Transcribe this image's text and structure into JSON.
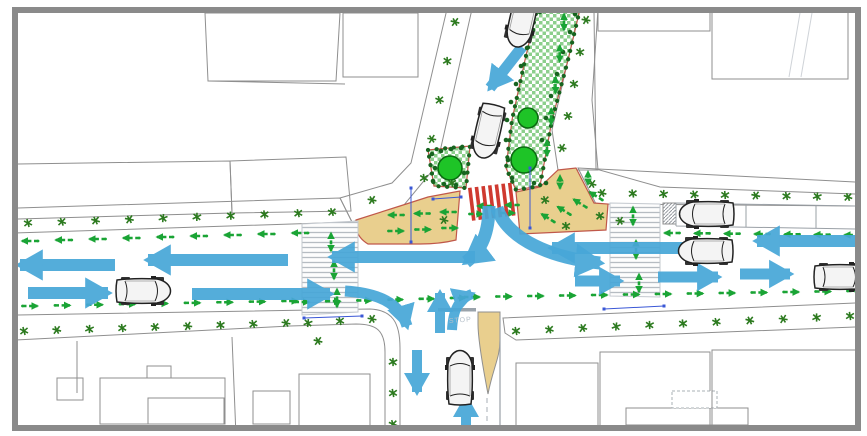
{
  "labels": {
    "stop_marking": "STOP"
  },
  "palette": {
    "frame": "#8a8a8a",
    "hatchline": "#ccd1d8",
    "outline": "#8f8f8f",
    "sidewalk": "#f5e7bd",
    "bulbout": "#e9cf8e",
    "road": "#ffffff",
    "checker": "#8ccf8c",
    "shrub": "#17641f",
    "tree": "#1ec427",
    "treestroke": "#0c6b12",
    "ped": "#1aa435",
    "plant": "#2c7a1f",
    "blue": "#48a7d8",
    "red": "#cf3a30",
    "red2": "#c0584a",
    "dim": "#3a57d6",
    "cwline": "#b6bcc2",
    "stop": "#b6c0ca",
    "curb": "#9aa3ab"
  },
  "map": {
    "plant_rows": [
      [
        28,
        223,
        332,
        212,
        10
      ],
      [
        455,
        22,
        424,
        178,
        5
      ],
      [
        602,
        193,
        848,
        197,
        9
      ],
      [
        24,
        331,
        286,
        323,
        9
      ],
      [
        308,
        323,
        372,
        319,
        3
      ],
      [
        393,
        362,
        393,
        424,
        3
      ],
      [
        516,
        331,
        850,
        316,
        11
      ],
      [
        586,
        20,
        562,
        148,
        5
      ]
    ],
    "plant_scatter": [
      [
        372,
        200
      ],
      [
        452,
        183
      ],
      [
        444,
        220
      ],
      [
        545,
        200
      ],
      [
        592,
        184
      ],
      [
        600,
        216
      ],
      [
        566,
        226
      ],
      [
        620,
        221
      ],
      [
        318,
        341
      ]
    ],
    "shrub_dots": [
      [
        540,
        12
      ],
      [
        533,
        30
      ],
      [
        527,
        48
      ],
      [
        521,
        66
      ],
      [
        516,
        84
      ],
      [
        511,
        102
      ],
      [
        507,
        120
      ],
      [
        506,
        140
      ],
      [
        508,
        160
      ],
      [
        512,
        178
      ],
      [
        534,
        183
      ],
      [
        546,
        183
      ],
      [
        575,
        14
      ],
      [
        570,
        32
      ],
      [
        563,
        52
      ],
      [
        557,
        74
      ],
      [
        551,
        96
      ],
      [
        546,
        118
      ],
      [
        542,
        140
      ],
      [
        432,
        154
      ],
      [
        441,
        151
      ],
      [
        451,
        149
      ],
      [
        461,
        148
      ],
      [
        435,
        168
      ],
      [
        433,
        181
      ],
      [
        444,
        184
      ],
      [
        456,
        185
      ],
      [
        464,
        173
      ]
    ],
    "trees": [
      [
        450,
        168,
        12
      ],
      [
        524,
        160,
        13
      ],
      [
        528,
        118,
        10
      ]
    ],
    "ped_rows": [
      [
        30,
        241,
        300,
        233,
        9,
        180,
        16,
        false
      ],
      [
        672,
        233,
        852,
        235,
        7,
        180,
        15,
        false
      ],
      [
        30,
        306,
        290,
        301,
        9,
        0,
        15,
        false
      ],
      [
        302,
        302,
        458,
        298,
        6,
        0,
        14,
        false
      ],
      [
        472,
        297,
        855,
        291,
        13,
        0,
        15,
        false
      ],
      [
        564,
        22,
        547,
        148,
        5,
        90,
        16,
        true
      ],
      [
        331,
        242,
        337,
        298,
        3,
        270,
        18,
        true
      ],
      [
        633,
        216,
        639,
        283,
        3,
        270,
        18,
        true
      ],
      [
        484,
        206,
        512,
        205,
        2,
        180,
        13,
        false
      ],
      [
        476,
        214,
        508,
        213,
        2,
        0,
        13,
        false
      ],
      [
        396,
        215,
        448,
        212,
        3,
        180,
        15,
        false
      ],
      [
        396,
        231,
        450,
        228,
        3,
        0,
        15,
        false
      ],
      [
        596,
        196,
        548,
        218,
        4,
        212,
        15,
        false
      ],
      [
        560,
        182,
        588,
        178,
        2,
        270,
        13,
        true
      ]
    ],
    "vehicle_arrows": [
      [
        20,
        265,
        180,
        95,
        12
      ],
      [
        148,
        260,
        180,
        140,
        12
      ],
      [
        332,
        257,
        180,
        143,
        12
      ],
      [
        552,
        248,
        180,
        138,
        12
      ],
      [
        757,
        241,
        180,
        100,
        12
      ],
      [
        108,
        293,
        0,
        80,
        12
      ],
      [
        330,
        294,
        0,
        138,
        12
      ],
      [
        620,
        281,
        0,
        45,
        11
      ],
      [
        718,
        277,
        0,
        60,
        11
      ],
      [
        790,
        274,
        0,
        50,
        11
      ],
      [
        417,
        392,
        90,
        42,
        10
      ],
      [
        440,
        293,
        270,
        40,
        10
      ],
      [
        466,
        398,
        270,
        38,
        10
      ],
      [
        490,
        88,
        128,
        52,
        11
      ]
    ],
    "vehicle_turns": [
      [
        "M345,291 C378,293 400,303 407,326",
        11
      ],
      [
        "M489,206 C489,232 482,250 466,262",
        13
      ],
      [
        "M497,208 C508,240 552,258 600,263",
        13
      ],
      [
        "M452,330 C453,311 458,299 472,294",
        10
      ]
    ],
    "cars": [
      [
        522,
        20,
        103
      ],
      [
        488,
        131,
        103
      ],
      [
        143,
        291,
        0
      ],
      [
        706,
        251,
        180
      ],
      [
        707,
        214,
        180
      ],
      [
        841,
        277,
        0
      ],
      [
        460,
        378,
        270
      ]
    ],
    "dimensions": [
      [
        433,
        199,
        461,
        197
      ],
      [
        411,
        188,
        411,
        242
      ],
      [
        530,
        168,
        530,
        228
      ],
      [
        304,
        318,
        362,
        316
      ],
      [
        604,
        309,
        664,
        306
      ]
    ],
    "red_crosswalk": {
      "x": 468,
      "y": 188,
      "rot": -7,
      "bars": 7,
      "bar_w": 3.6,
      "gap": 3.1,
      "bar_h": 33
    }
  }
}
